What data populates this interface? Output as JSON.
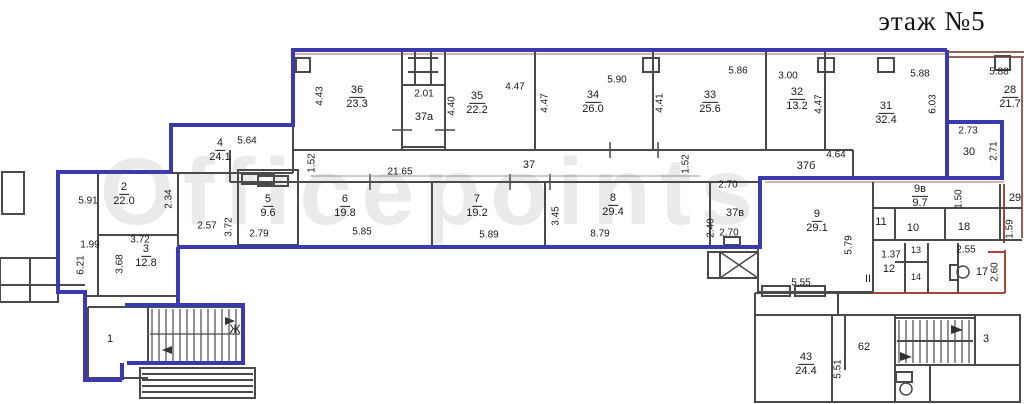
{
  "title": "этаж №5",
  "watermark": "Officepoints",
  "colors": {
    "boundary_blue": "#3a3aae",
    "boundary_red": "#a6453a",
    "boundary_brown": "#95625a",
    "wall_gray": "#4a4a4a"
  },
  "rooms": {
    "r36": {
      "number": "36",
      "area": "23.3"
    },
    "r35": {
      "number": "35",
      "area": "22.2"
    },
    "r34": {
      "number": "34",
      "area": "26.0"
    },
    "r33": {
      "number": "33",
      "area": "25.6"
    },
    "r32": {
      "number": "32",
      "area": "13.2"
    },
    "r31": {
      "number": "31",
      "area": "32.4"
    },
    "r28": {
      "number": "28",
      "area": "21.7"
    },
    "r4": {
      "number": "4",
      "area": "24.1"
    },
    "r2": {
      "number": "2",
      "area": "22.0"
    },
    "r3": {
      "number": "3",
      "area": "12.8"
    },
    "r5": {
      "number": "5",
      "area": "9.6"
    },
    "r6": {
      "number": "6",
      "area": "19.8"
    },
    "r7": {
      "number": "7",
      "area": "19.2"
    },
    "r8": {
      "number": "8",
      "area": "29.4"
    },
    "r9": {
      "number": "9",
      "area": "29.1"
    },
    "r9v": {
      "number": "9в",
      "area": "9.7"
    },
    "r43": {
      "number": "43",
      "area": "24.4"
    }
  },
  "spaces": {
    "corridor": "37",
    "room_37a": "37а",
    "room_37b": "37б",
    "room_37v": "37в",
    "room_1": "1",
    "room_10": "10",
    "room_11": "11",
    "room_12": "12",
    "room_13": "13",
    "room_14": "14",
    "room_17": "17",
    "room_18": "18",
    "room_29": "29",
    "room_30": "30",
    "room_62": "62",
    "stairs_right": "3",
    "stairs_left": "Ж",
    "section_mark": "II"
  },
  "dimensions": [
    "4.43",
    "2.01",
    "4.40",
    "4.47",
    "5.90",
    "4.47",
    "5.86",
    "4.41",
    "3.00",
    "4.47",
    "5.88",
    "6.03",
    "5.88",
    "2.73",
    "2.71",
    "5.64",
    "2.34",
    "5.91",
    "1.99",
    "6.21",
    "3.72",
    "3.68",
    "2.57",
    "3.72",
    "2.79",
    "1.52",
    "21.65",
    "5.85",
    "5.89",
    "3.45",
    "8.79",
    "1.52",
    "2.70",
    "2.40",
    "2.70",
    "4.64",
    "5.79",
    "5.55",
    "1.50",
    "1.59",
    "2.55",
    "1.37",
    "2.60",
    "5.51"
  ]
}
